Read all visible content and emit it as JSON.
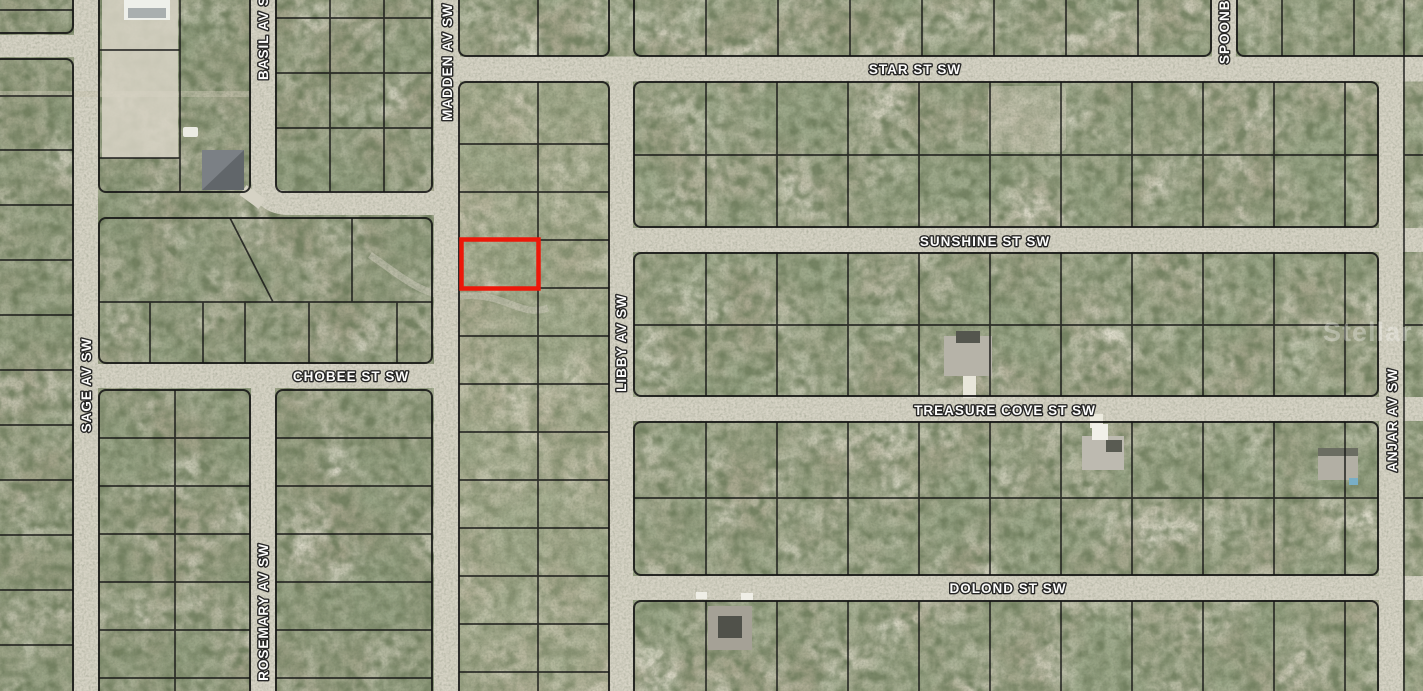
{
  "map": {
    "description": "Aerial parcel map with highlighted lot",
    "watermark": "Stellar MLS",
    "colors": {
      "highlight": "#ec1809",
      "road": "#d6d3c5",
      "parcel_line": "#151515",
      "terrain_base": "#a8a78e"
    },
    "highlighted_parcel": {
      "present": true,
      "outline_color": "#ec1809"
    },
    "streets": {
      "star": {
        "label": "STAR ST SW",
        "orientation": "horizontal"
      },
      "sunshine": {
        "label": "SUNSHINE ST SW",
        "orientation": "horizontal"
      },
      "chobee": {
        "label": "CHOBEE ST SW",
        "orientation": "horizontal"
      },
      "treasure_cove": {
        "label": "TREASURE COVE ST SW",
        "orientation": "horizontal"
      },
      "dolond": {
        "label": "DOLOND ST SW",
        "orientation": "horizontal"
      },
      "sage": {
        "label": "SAGE AV SW",
        "orientation": "vertical"
      },
      "basil": {
        "label": "BASIL AV SW",
        "orientation": "vertical"
      },
      "rosemary": {
        "label": "ROSEMARY AV SW",
        "orientation": "vertical"
      },
      "madden": {
        "label": "MADDEN AV SW",
        "orientation": "vertical"
      },
      "libby": {
        "label": "LIBBY AV SW",
        "orientation": "vertical"
      },
      "spoonbill": {
        "label": "SPOONBILL",
        "orientation": "vertical"
      },
      "anjar": {
        "label": "ANJAR AV SW",
        "orientation": "vertical"
      }
    }
  }
}
